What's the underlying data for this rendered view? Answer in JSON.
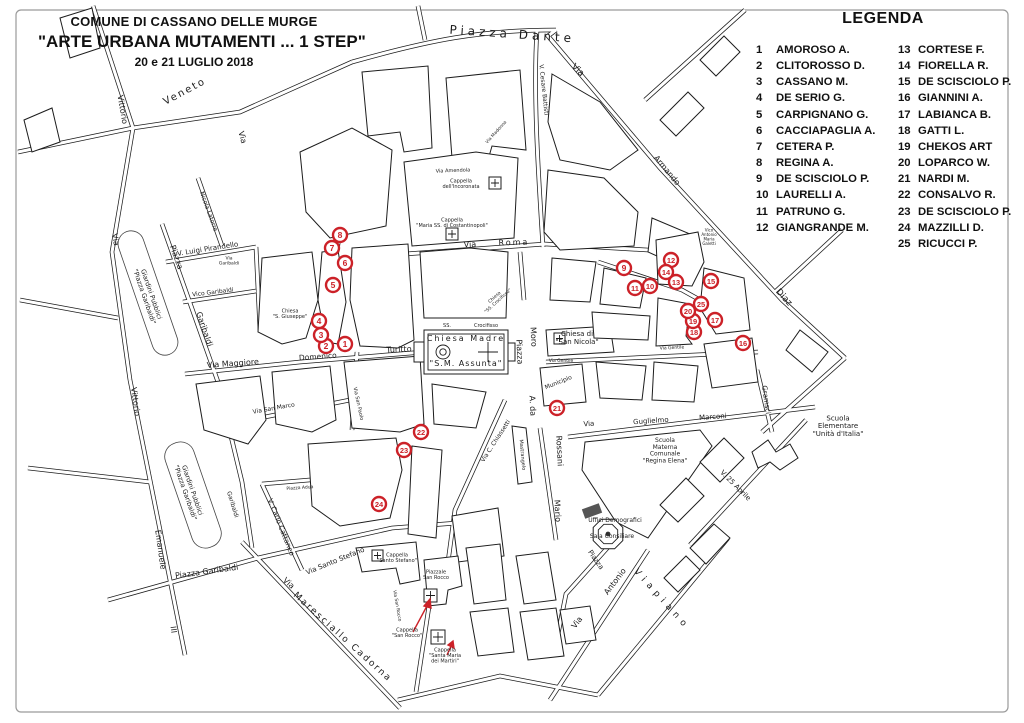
{
  "header": {
    "line1": "COMUNE DI CASSANO DELLE MURGE",
    "line2": "\"ARTE URBANA MUTAMENTI ... 1 STEP\"",
    "line3": "20 e 21 LUGLIO 2018"
  },
  "legend": {
    "title": "LEGENDA",
    "col1": [
      {
        "n": "1",
        "name": "AMOROSO A."
      },
      {
        "n": "2",
        "name": "CLITOROSSO D."
      },
      {
        "n": "3",
        "name": "CASSANO M."
      },
      {
        "n": "4",
        "name": "DE SERIO G."
      },
      {
        "n": "5",
        "name": "CARPIGNANO G."
      },
      {
        "n": "6",
        "name": "CACCIAPAGLIA A."
      },
      {
        "n": "7",
        "name": "CETERA P."
      },
      {
        "n": "8",
        "name": "REGINA A."
      },
      {
        "n": "9",
        "name": "DE SCISCIOLO P."
      },
      {
        "n": "10",
        "name": "LAURELLI A."
      },
      {
        "n": "11",
        "name": "PATRUNO G."
      },
      {
        "n": "12",
        "name": "GIANGRANDE M."
      }
    ],
    "col2": [
      {
        "n": "13",
        "name": "CORTESE F."
      },
      {
        "n": "14",
        "name": "FIORELLA R."
      },
      {
        "n": "15",
        "name": "DE SCISCIOLO P."
      },
      {
        "n": "16",
        "name": "GIANNINI A."
      },
      {
        "n": "17",
        "name": "LABIANCA B."
      },
      {
        "n": "18",
        "name": "GATTI L."
      },
      {
        "n": "19",
        "name": "CHEKOS ART"
      },
      {
        "n": "20",
        "name": "LOPARCO W."
      },
      {
        "n": "21",
        "name": "NARDI M."
      },
      {
        "n": "22",
        "name": "CONSALVO R."
      },
      {
        "n": "23",
        "name": "DE SCISCIOLO P."
      },
      {
        "n": "24",
        "name": "MAZZILLI D."
      },
      {
        "n": "25",
        "name": "RICUCCI P."
      }
    ]
  },
  "map": {
    "marker_color": "#cc2128",
    "markers": [
      {
        "n": 1,
        "x": 345,
        "y": 344
      },
      {
        "n": 2,
        "x": 326,
        "y": 346
      },
      {
        "n": 3,
        "x": 321,
        "y": 335
      },
      {
        "n": 4,
        "x": 319,
        "y": 321
      },
      {
        "n": 5,
        "x": 333,
        "y": 285
      },
      {
        "n": 6,
        "x": 345,
        "y": 263
      },
      {
        "n": 7,
        "x": 332,
        "y": 248
      },
      {
        "n": 8,
        "x": 340,
        "y": 235
      },
      {
        "n": 9,
        "x": 624,
        "y": 268
      },
      {
        "n": 10,
        "x": 650,
        "y": 286
      },
      {
        "n": 11,
        "x": 635,
        "y": 288
      },
      {
        "n": 12,
        "x": 671,
        "y": 260
      },
      {
        "n": 13,
        "x": 676,
        "y": 282
      },
      {
        "n": 14,
        "x": 666,
        "y": 272
      },
      {
        "n": 15,
        "x": 711,
        "y": 281
      },
      {
        "n": 16,
        "x": 743,
        "y": 343
      },
      {
        "n": 17,
        "x": 715,
        "y": 320
      },
      {
        "n": 18,
        "x": 694,
        "y": 332
      },
      {
        "n": 19,
        "x": 693,
        "y": 321
      },
      {
        "n": 20,
        "x": 688,
        "y": 311
      },
      {
        "n": 21,
        "x": 557,
        "y": 408
      },
      {
        "n": 22,
        "x": 421,
        "y": 432
      },
      {
        "n": 23,
        "x": 404,
        "y": 450
      },
      {
        "n": 24,
        "x": 379,
        "y": 504
      },
      {
        "n": 25,
        "x": 701,
        "y": 304
      }
    ],
    "labels": [
      {
        "t": "Piazza Dante",
        "x": 512,
        "y": 38,
        "r": 4,
        "s": 12,
        "ls": 4
      },
      {
        "t": "Veneto",
        "x": 186,
        "y": 94,
        "r": -28,
        "s": 10,
        "ls": 2
      },
      {
        "t": "Via",
        "x": 240,
        "y": 138,
        "r": 75,
        "s": 8
      },
      {
        "t": "Vittorio",
        "x": 120,
        "y": 110,
        "r": 80,
        "s": 8
      },
      {
        "t": "Via",
        "x": 113,
        "y": 240,
        "r": 80,
        "s": 8
      },
      {
        "t": "Piazza",
        "x": 174,
        "y": 258,
        "r": 71,
        "s": 8
      },
      {
        "t": "Garibaldi",
        "x": 202,
        "y": 330,
        "r": 71,
        "s": 8
      },
      {
        "t": "Giardini Pubblici|\"Piazza Garibaldi\"",
        "x": 146,
        "y": 296,
        "r": 71,
        "s": 6.5
      },
      {
        "t": "V. Luigi Pirandello",
        "x": 208,
        "y": 251,
        "r": -9,
        "s": 7
      },
      {
        "t": "Vico Garibaldi",
        "x": 213,
        "y": 294,
        "r": -7,
        "s": 6
      },
      {
        "t": "Via|Garibaldi",
        "x": 229,
        "y": 262,
        "r": 0,
        "s": 4.5
      },
      {
        "t": "Nicola Latorre",
        "x": 207,
        "y": 212,
        "r": 70,
        "s": 6
      },
      {
        "t": "Via Maggiore",
        "x": 233,
        "y": 366,
        "r": -4,
        "s": 8
      },
      {
        "t": "Domenico",
        "x": 318,
        "y": 359,
        "r": -4,
        "s": 7.5
      },
      {
        "t": "Turitto",
        "x": 399,
        "y": 352,
        "r": -3,
        "s": 8
      },
      {
        "t": "Chiesa|\"S. Giuseppe\"",
        "x": 290,
        "y": 315,
        "r": 0,
        "s": 5
      },
      {
        "t": "Vittorio",
        "x": 133,
        "y": 402,
        "r": 82,
        "s": 8
      },
      {
        "t": "Emanuele",
        "x": 158,
        "y": 550,
        "r": 82,
        "s": 8
      },
      {
        "t": "III",
        "x": 171,
        "y": 630,
        "r": 82,
        "s": 8
      },
      {
        "t": "Giardini Pubblici|\"Piazza Garibaldi\"",
        "x": 187,
        "y": 492,
        "r": 71,
        "s": 6.5
      },
      {
        "t": "Garibaldi",
        "x": 231,
        "y": 505,
        "r": 73,
        "s": 6
      },
      {
        "t": "Piazza Garibaldi",
        "x": 207,
        "y": 574,
        "r": -8,
        "s": 8
      },
      {
        "t": "Via",
        "x": 287,
        "y": 585,
        "r": 42,
        "s": 8
      },
      {
        "t": "Maresciallo Cadorna",
        "x": 341,
        "y": 639,
        "r": 42,
        "s": 9,
        "ls": 2
      },
      {
        "t": "Via Santo Stefano",
        "x": 336,
        "y": 563,
        "r": -22,
        "s": 7
      },
      {
        "t": "V. Carlo Cattaneo",
        "x": 279,
        "y": 528,
        "r": 68,
        "s": 7
      },
      {
        "t": "Piazza Adua",
        "x": 300,
        "y": 489,
        "r": -4,
        "s": 4.5
      },
      {
        "t": "Via San Marco",
        "x": 274,
        "y": 410,
        "r": -10,
        "s": 6
      },
      {
        "t": "Via San Paolo",
        "x": 357,
        "y": 404,
        "r": 78,
        "s": 5
      },
      {
        "t": "SS.",
        "x": 447,
        "y": 327,
        "r": 0,
        "s": 5
      },
      {
        "t": "Crocifisso",
        "x": 486,
        "y": 327,
        "r": 0,
        "s": 5
      },
      {
        "t": "Chiesa Madre",
        "x": 466,
        "y": 341,
        "r": 0,
        "s": 8,
        "ls": 2
      },
      {
        "t": "\"S.M. Assunta\"",
        "x": 466,
        "y": 366,
        "r": 0,
        "s": 8,
        "ls": 1
      },
      {
        "t": "Chiesa|\"SS. Crocifisso\"",
        "x": 497,
        "y": 300,
        "r": -42,
        "s": 4.5
      },
      {
        "t": "Cappella|dell'Incoronata",
        "x": 461,
        "y": 185,
        "r": 0,
        "s": 5
      },
      {
        "t": "Cappella|\"Maria SS. di Costantinopoli\"",
        "x": 452,
        "y": 224,
        "r": 0,
        "s": 5
      },
      {
        "t": "Via",
        "x": 470,
        "y": 247,
        "r": -2,
        "s": 8
      },
      {
        "t": "Roma",
        "x": 514,
        "y": 245,
        "r": -2,
        "s": 8,
        "ls": 2
      },
      {
        "t": "Via Amendola",
        "x": 453,
        "y": 172,
        "r": -2,
        "s": 5
      },
      {
        "t": "Via Madonna",
        "x": 497,
        "y": 133,
        "r": -48,
        "s": 4.5
      },
      {
        "t": "V. Cesare Battisti",
        "x": 542,
        "y": 90,
        "r": 84,
        "s": 6
      },
      {
        "t": "Via",
        "x": 576,
        "y": 72,
        "r": 44,
        "s": 9
      },
      {
        "t": "Armando",
        "x": 665,
        "y": 172,
        "r": 50,
        "s": 8
      },
      {
        "t": "Diaz",
        "x": 782,
        "y": 299,
        "r": 48,
        "s": 9
      },
      {
        "t": "Piazza",
        "x": 517,
        "y": 352,
        "r": 87,
        "s": 8
      },
      {
        "t": "Moro",
        "x": 531,
        "y": 337,
        "r": 87,
        "s": 8
      },
      {
        "t": "A. da",
        "x": 530,
        "y": 406,
        "r": 87,
        "s": 8
      },
      {
        "t": "Rossani",
        "x": 557,
        "y": 451,
        "r": 87,
        "s": 8
      },
      {
        "t": "Mario",
        "x": 555,
        "y": 511,
        "r": 87,
        "s": 8
      },
      {
        "t": "Mastrangelo",
        "x": 521,
        "y": 455,
        "r": 85,
        "s": 5
      },
      {
        "t": "Via C. Chiassetti",
        "x": 497,
        "y": 442,
        "r": -57,
        "s": 6
      },
      {
        "t": "Chiesa di|\"San Nicola\"",
        "x": 577,
        "y": 340,
        "r": 0,
        "s": 7
      },
      {
        "t": "Municipio",
        "x": 559,
        "y": 384,
        "r": -22,
        "s": 6
      },
      {
        "t": "Via Gentile",
        "x": 561,
        "y": 362,
        "r": 0,
        "s": 4.5
      },
      {
        "t": "Via Gentile",
        "x": 672,
        "y": 349,
        "r": -3,
        "s": 4.5
      },
      {
        "t": "Via",
        "x": 589,
        "y": 426,
        "r": -4,
        "s": 7
      },
      {
        "t": "Guglielmo",
        "x": 651,
        "y": 423,
        "r": -4,
        "s": 7
      },
      {
        "t": "Marconi",
        "x": 713,
        "y": 419,
        "r": -4,
        "s": 7
      },
      {
        "t": "Scuola|Materna|Comunale|\"Regina Elena\"",
        "x": 665,
        "y": 452,
        "r": 0,
        "s": 6
      },
      {
        "t": "Scuola|Elementare|\"Unità d'Italia\"",
        "x": 838,
        "y": 428,
        "r": 0,
        "s": 7
      },
      {
        "t": "Uffici Demografici",
        "x": 615,
        "y": 522,
        "r": 0,
        "s": 6
      },
      {
        "t": "Sala Consiliare",
        "x": 612,
        "y": 538,
        "r": 0,
        "s": 6
      },
      {
        "t": "Piazza",
        "x": 594,
        "y": 561,
        "r": 55,
        "s": 7
      },
      {
        "t": "Antonio",
        "x": 617,
        "y": 583,
        "r": -53,
        "s": 8
      },
      {
        "t": "Via",
        "x": 579,
        "y": 624,
        "r": -53,
        "s": 8
      },
      {
        "t": "Viapiano",
        "x": 660,
        "y": 601,
        "r": 48,
        "s": 9,
        "ls": 5
      },
      {
        "t": "V. 25 Aprile",
        "x": 734,
        "y": 487,
        "r": 45,
        "s": 7
      },
      {
        "t": "Gramsci",
        "x": 764,
        "y": 400,
        "r": 82,
        "s": 7
      },
      {
        "t": "Vico|Antonio|Maria|Galetti",
        "x": 709,
        "y": 238,
        "r": 0,
        "s": 4
      },
      {
        "t": "Cappella|\"Santo Stefano\"",
        "x": 397,
        "y": 559,
        "r": 0,
        "s": 5
      },
      {
        "t": "Piazzale|San Rocco",
        "x": 436,
        "y": 576,
        "r": 0,
        "s": 5
      },
      {
        "t": "Cappella|\"San Rocco\"",
        "x": 407,
        "y": 634,
        "r": 0,
        "s": 5
      },
      {
        "t": "Cappella|\"Santa Maria|dei Martiri\"",
        "x": 445,
        "y": 657,
        "r": 0,
        "s": 5
      },
      {
        "t": "Via San Rocco",
        "x": 396,
        "y": 606,
        "r": 80,
        "s": 4.5
      }
    ]
  }
}
